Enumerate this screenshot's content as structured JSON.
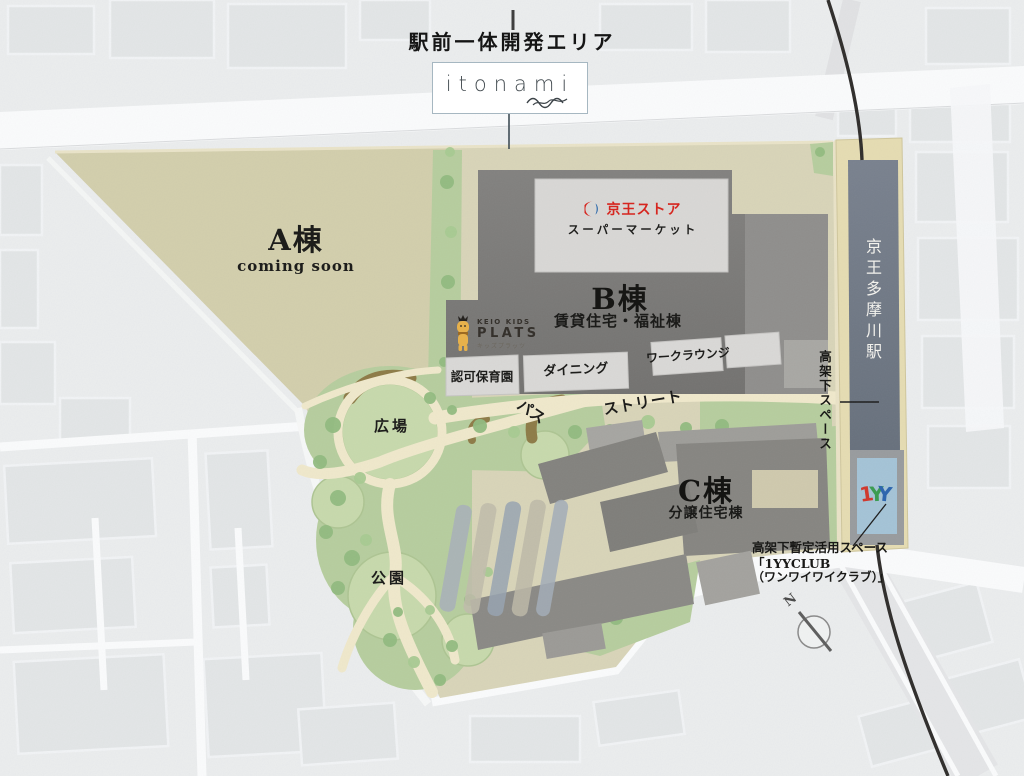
{
  "header": {
    "title": "駅前一体開発エリア",
    "brand": "itonami"
  },
  "buildings": {
    "a": {
      "name": "A棟",
      "status": "coming soon"
    },
    "b": {
      "name": "B棟",
      "type": "賃貸住宅・福祉棟"
    },
    "c": {
      "name": "C棟",
      "type": "分譲住宅棟"
    }
  },
  "tenants": {
    "keio_store": {
      "name": "京王ストア",
      "category": "スーパーマーケット"
    },
    "kids_plats": {
      "line1": "KEIO KIDS",
      "line2": "PLATS",
      "line3": "キッズプラッツ"
    },
    "nursery": {
      "label": "認可保育園"
    },
    "dining": {
      "label": "ダイニング"
    },
    "work_lounge": {
      "label": "ワークラウンジ"
    }
  },
  "open_space": {
    "plaza": "広場",
    "park": "公園",
    "path": "パス",
    "street": "ストリート"
  },
  "station": {
    "name": "京王多摩川駅",
    "under_viaduct": "高架下スペース"
  },
  "annotation": {
    "line1": "高架下暫定活用スペース",
    "line2": "「1YYCLUB",
    "line3": "（ワンワイワイクラブ）」",
    "logo_chars": {
      "c1": "1",
      "c2": "Y",
      "c3": "Y"
    }
  },
  "compass": {
    "north": "N"
  },
  "colors": {
    "keio_red": "#d6261f",
    "keio_blue": "#1d5fa7",
    "one_yy_red": "#cf3a2f",
    "one_yy_green": "#3c9c52",
    "one_yy_blue": "#2e66ae",
    "site_green": "#b6cd9e",
    "site_beige": "#d8d4b8",
    "building_gray": "#7a7977",
    "station_slate": "#6e7683"
  }
}
